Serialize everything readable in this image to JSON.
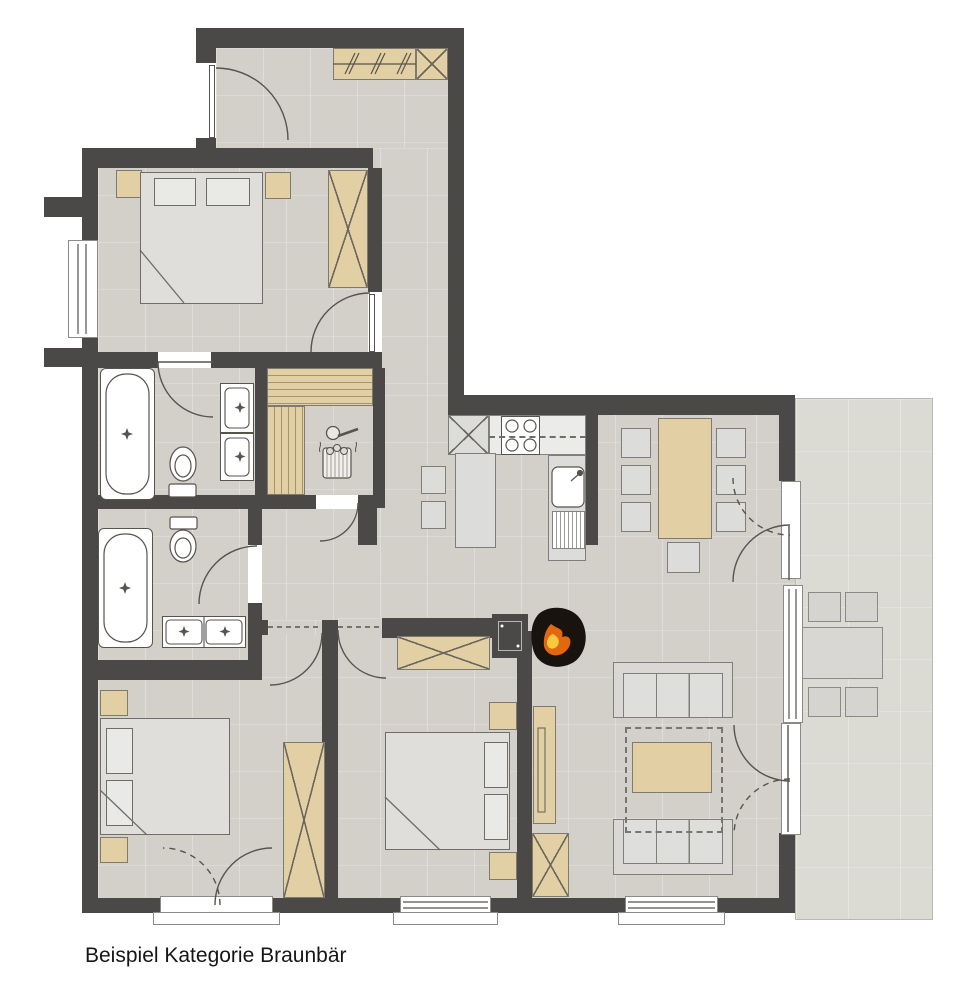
{
  "caption": "Beispiel Kategorie Braunbär",
  "palette": {
    "wall": "#4a4947",
    "floor": "#d3d0ca",
    "terrace": "#dbdad3",
    "wood": "#e2cfa4",
    "furn": "#dcdcda",
    "bedFill": "#dfdedb",
    "fixture": "#ffffff",
    "lineCol": "#57534e",
    "flameBody": "#18130f",
    "flameMid": "#e2680f",
    "flameCore": "#f7c93e",
    "captionCol": "#161616"
  },
  "icons": {
    "fireplace": "wood-stove with flame",
    "sauna_heater": "bucket with ladle and stones",
    "stove": "4 burner circles",
    "coat_rack": "double slash hooks",
    "wardrobe": "crossed rectangle",
    "bathtub": "oval in rectangle with star drain",
    "sink": "square with 4-point star faucet",
    "toilet": "oval bowl with cistern"
  }
}
